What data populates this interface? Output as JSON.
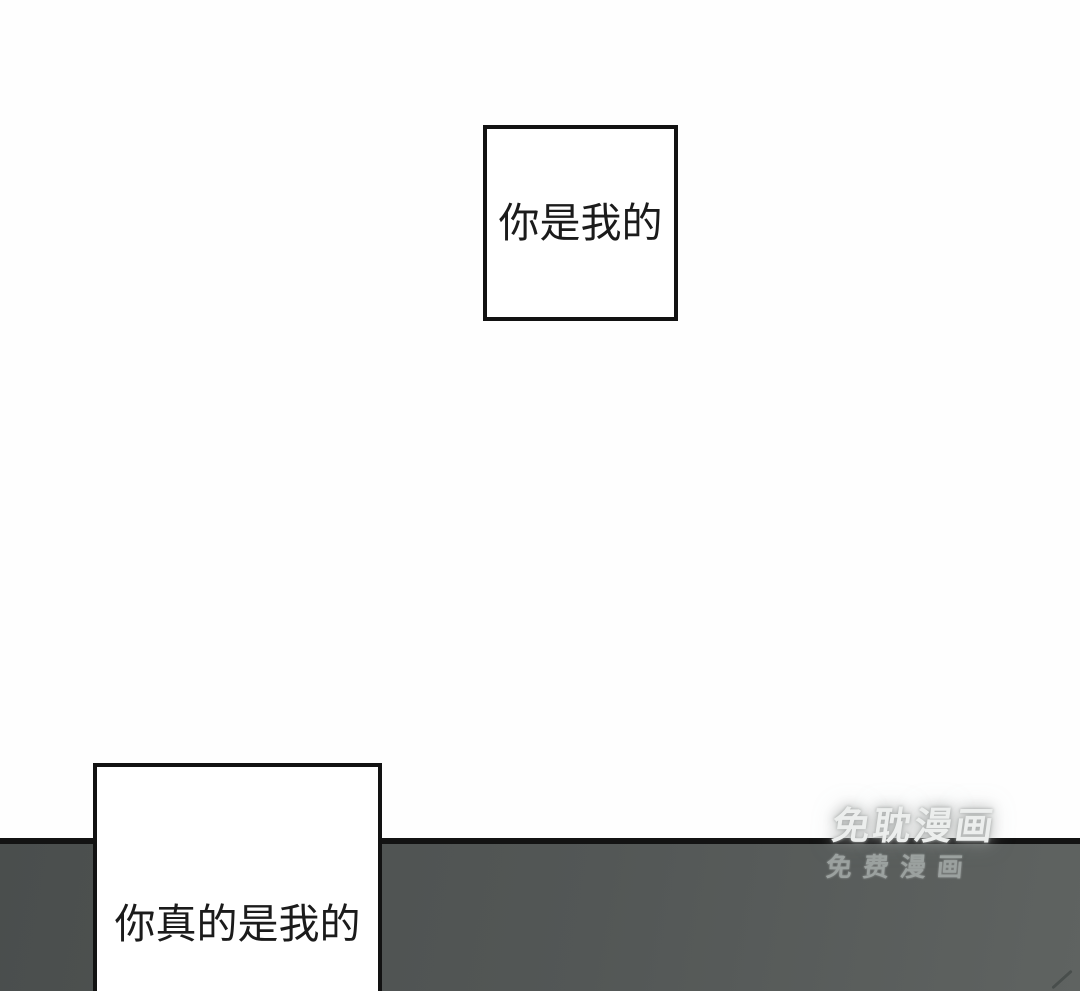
{
  "page": {
    "background_color": "#fefefe"
  },
  "bubbles": {
    "top": {
      "text": "你是我的"
    },
    "bottom": {
      "text": "你真的是我的"
    }
  },
  "panel_band": {
    "fill_color_left": "#4a4e4d",
    "fill_color_right": "#5f6361",
    "top_line_color": "#131313"
  },
  "watermark": {
    "line1": "免耽漫画",
    "line2": "免费漫画",
    "line1_color": "#eceeed",
    "line2_color": "#9ba19f"
  }
}
